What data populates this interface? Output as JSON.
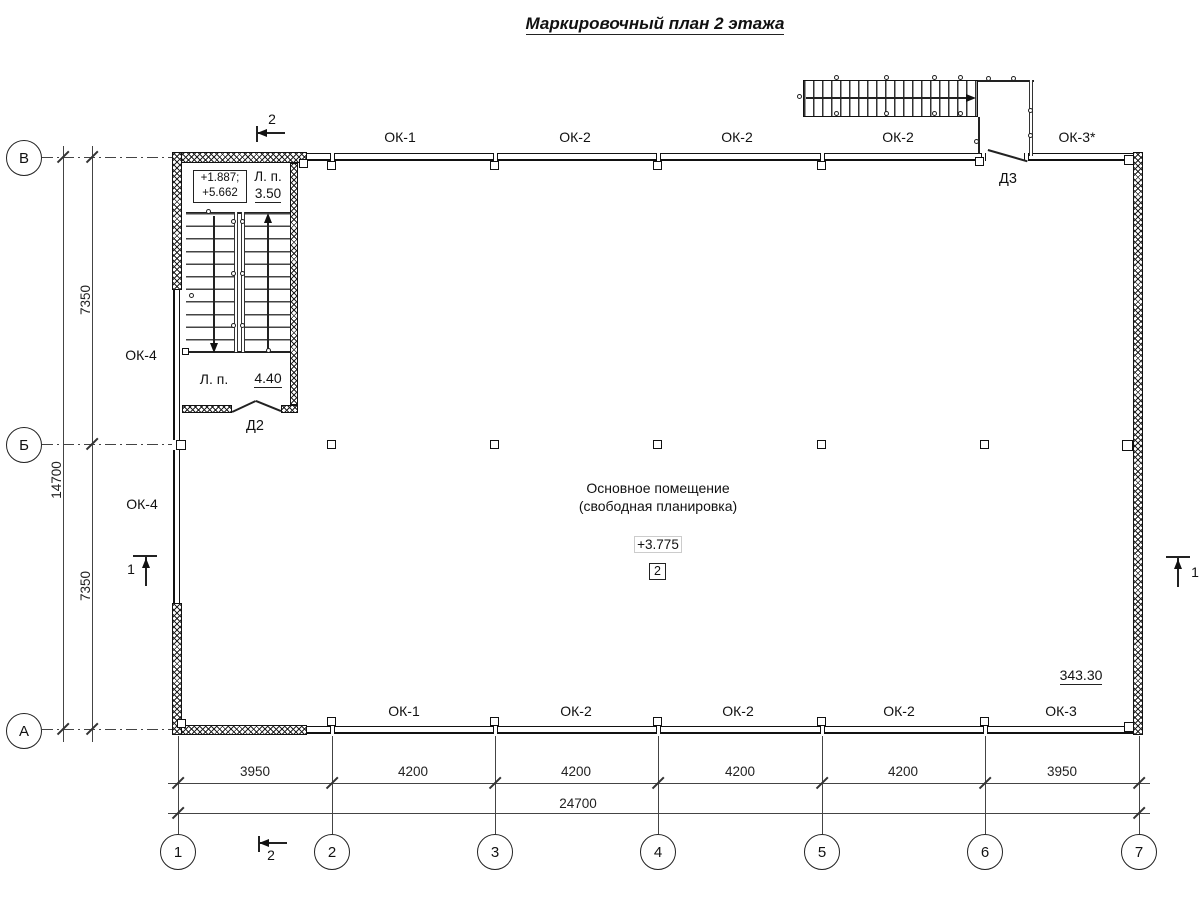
{
  "title": "Маркировочный план 2 этажа",
  "axes": {
    "cols": [
      "1",
      "2",
      "3",
      "4",
      "5",
      "6",
      "7"
    ],
    "rows": [
      "В",
      "Б",
      "А"
    ]
  },
  "dims": {
    "col_segments": [
      "3950",
      "4200",
      "4200",
      "4200",
      "4200",
      "3950"
    ],
    "col_total": "24700",
    "row_segments": [
      "7350",
      "7350"
    ],
    "row_total": "14700"
  },
  "windows": {
    "top": [
      "ОК-1",
      "ОК-2",
      "ОК-2",
      "ОК-2",
      "ОК-3*"
    ],
    "bottom": [
      "ОК-1",
      "ОК-2",
      "ОК-2",
      "ОК-2",
      "ОК-3"
    ],
    "left_upper": "ОК-4",
    "left_lower": "ОК-4"
  },
  "doors": {
    "stair_door": "Д2",
    "escape_door": "Д3"
  },
  "stairwell": {
    "elev_line1": "+1.887;",
    "elev_line2": "+5.662",
    "upper_landing_label": "Л. п.",
    "upper_landing_value": "3.50",
    "lower_landing_label": "Л. п.",
    "lower_landing_value": "4.40"
  },
  "room": {
    "name": "Основное помещение",
    "name2": "(свободная планировка)",
    "elevation": "+3.775",
    "number": "2",
    "area": "343.30"
  },
  "sections": {
    "mark1": "1",
    "mark2": "2"
  }
}
